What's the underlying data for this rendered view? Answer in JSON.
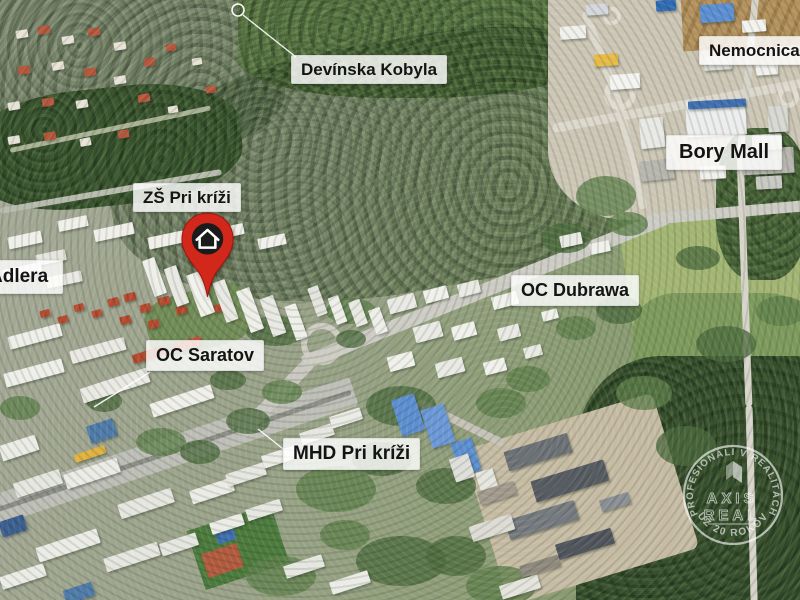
{
  "map_labels": {
    "devinska_kobyla": "Devínska Kobyla",
    "nemocnica_bory": "Nemocnica Bory",
    "bory_mall": "Bory Mall",
    "zs_pri_krizi": "ZŠ Pri kríži",
    "adlera": "Adlera",
    "oc_dubrawa": "OC Dubrawa",
    "oc_saratov": "OC Saratov",
    "mhd_pri_krizi": "MHD Pri kríži"
  },
  "marker": {
    "type": "property-location-pin",
    "icon": "house-icon"
  },
  "watermark": {
    "arc_top": "PROFESIONÁLI V REALITÁCH",
    "arc_bottom": "UŽ 20 ROKOV",
    "logo_line1": "AXIS",
    "logo_line2": "REAL"
  },
  "colors": {
    "pin_red": "#d2281c",
    "pin_circle": "#1b1b1b",
    "label_bg": "#ffffff",
    "label_text": "#141414",
    "watermark_white": "#ffffff",
    "forest_green": "#36502b",
    "urban_gray_green": "#9aa389"
  }
}
